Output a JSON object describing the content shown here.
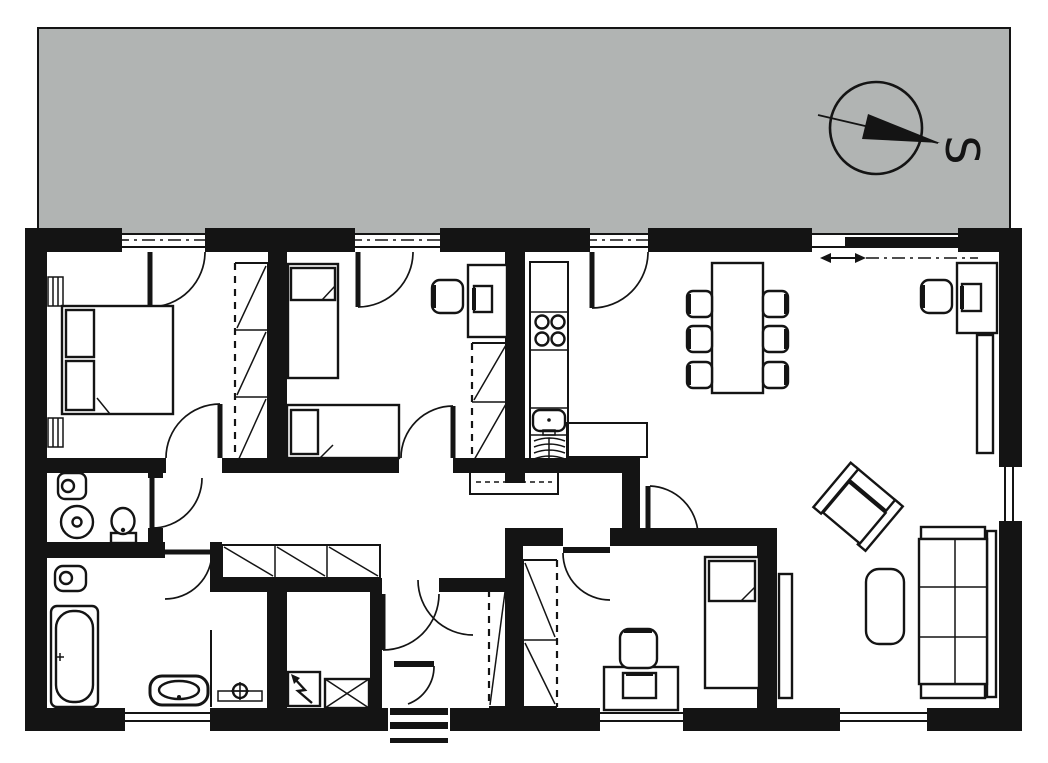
{
  "compass": {
    "label": "S",
    "direction_shown": "south",
    "style": "circle-with-needle"
  },
  "palette": {
    "wall": "#141414",
    "line": "#141414",
    "terrace": "#b1b4b3",
    "paper": "#ffffff"
  },
  "plan": {
    "type": "single-storey house floor plan",
    "exterior": [
      "terrace along full top side",
      "compass rose on terrace pointing to S"
    ],
    "top_wall_openings": [
      "terrace door bedroom 1",
      "terrace door bedroom 2",
      "terrace door kitchen",
      "sliding terrace door living room"
    ],
    "rooms": [
      {
        "name": "master bedroom",
        "furniture": [
          "double bed with two pillows",
          "wardrobe with 3 hatched sections",
          "two radiators"
        ]
      },
      {
        "name": "second bedroom",
        "furniture": [
          "single bed vertical",
          "single bed horizontal",
          "desk with chair and monitor",
          "wardrobe with 2 hatched sections"
        ]
      },
      {
        "name": "kitchen",
        "furniture": [
          "tall cabinet",
          "4-burner hob",
          "worktop",
          "sink",
          "dishwasher",
          "peninsula counter"
        ]
      },
      {
        "name": "living-dining room",
        "furniture": [
          "dining table with six chairs",
          "desk with chair and monitor",
          "sideboard",
          "rotated armchair",
          "coffee table",
          "three-seat sofa",
          "console beside bedroom wall"
        ]
      },
      {
        "name": "hallway",
        "furniture": [
          "built-in wardrobe row with 3 hatched sections",
          "attic access hatch"
        ]
      },
      {
        "name": "wc",
        "furniture": [
          "hand basin",
          "washing machine",
          "toilet",
          "radiator"
        ]
      },
      {
        "name": "bathroom",
        "furniture": [
          "hand basin",
          "bathtub",
          "vanity basin",
          "shower screen",
          "shower fitting"
        ]
      },
      {
        "name": "technical room",
        "furniture": [
          "electrical cabinet with lightning symbol",
          "crossed utility box"
        ]
      },
      {
        "name": "entrance hall",
        "furniture": [
          "narrow hatched closet",
          "front door with exterior steps"
        ]
      },
      {
        "name": "third bedroom",
        "furniture": [
          "single bed with pillow",
          "desk with chair and monitor",
          "two-section hatched closet"
        ]
      }
    ],
    "windows": [
      "bathroom bottom window",
      "bedroom 3 bottom window",
      "living room bottom window",
      "living room right-side window"
    ],
    "doors_count": 12
  }
}
